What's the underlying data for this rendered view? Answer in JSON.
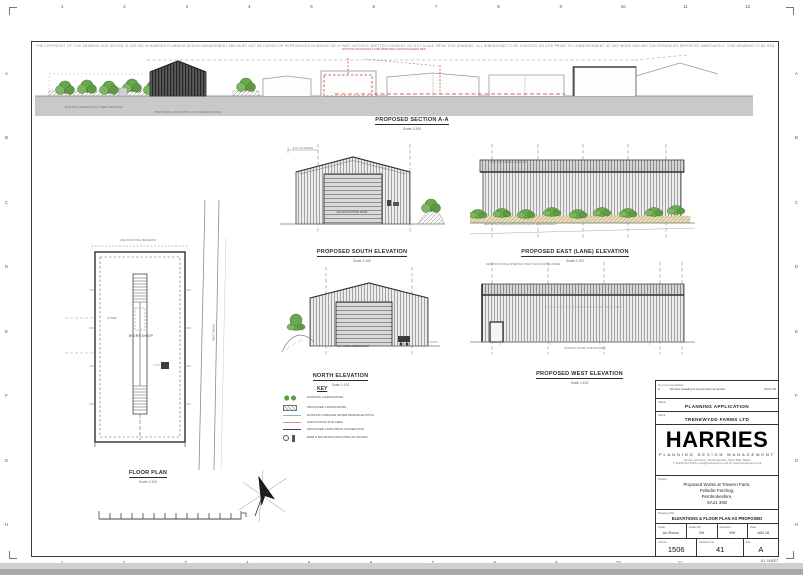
{
  "colors": {
    "demolition_red": "#c0392b",
    "landscape_green": "#6aa84f",
    "ground_grey": "#c9c9c9",
    "drain_lightblue": "#8ab4d8",
    "site_pink": "#d98a8a",
    "drain_darkblue": "#3b4a6b"
  },
  "sheet": {
    "disclaimer": "THE COPYRIGHT OF THIS DRAWING AND DESIGN IS VESTED IN HARRIES PLANNING DESIGN MANAGEMENT AND MUST NOT BE COPIED OR REPRODUCED IN WHOLE OR IN PART WITHOUT WRITTEN CONSENT. DO NOT SCALE FROM THIS DRAWING. ALL DIMENSIONS TO BE CHECKED ON SITE PRIOR TO COMMENCEMENT OF ANY WORK AND ANY DISCREPANCIES REPORTED IMMEDIATELY. THIS DRAWING TO BE READ IN CONJUNCTION WITH ALL RELEVANT CONSULTANTS DRAWINGS AND SPECIFICATIONS.",
    "size_label": "A1 SHEET",
    "frame": {
      "top_numbers": [
        "1",
        "2",
        "3",
        "4",
        "5",
        "6",
        "7",
        "8",
        "9",
        "10",
        "11",
        "12"
      ],
      "bottom_numbers": [
        "1",
        "2",
        "3",
        "4",
        "5",
        "6",
        "7",
        "8",
        "9",
        "10",
        "11"
      ],
      "left_letters": [
        "A",
        "B",
        "C",
        "D",
        "E",
        "F",
        "G",
        "H"
      ],
      "right_letters": [
        "A",
        "B",
        "C",
        "D",
        "E",
        "F",
        "G",
        "H"
      ]
    }
  },
  "drawings": {
    "section": {
      "title": "PROPOSED SECTION A-A",
      "scale": "Scale 1:200",
      "red_note": "EXISTING BUILDINGS TO BE REMOVED SHOWN DASHED RED",
      "hedge_note": "EXISTING HEDGEROW & TREES RETAINED",
      "landscape_note": "PROPOSED LANDSCAPING TO SCREEN BUILDING"
    },
    "south": {
      "title": "PROPOSED SOUTH ELEVATION",
      "scale": "Scale 1:100",
      "ridge_note": "6.1m TO RIDGE",
      "door_note": "ROLLER SHUTTER DOOR"
    },
    "east": {
      "title": "PROPOSED EAST (LANE) ELEVATION",
      "scale": "Scale 1:100",
      "note": "NEW NATIVE HEDGEROW PLANTING ALONG LANE BOUNDARY",
      "cladding_note": "GREY BOX PROFILE CLADDING"
    },
    "north": {
      "title": "NORTH ELEVATION",
      "scale": "Scale 1:100",
      "door_note": "6.0m WIDE ACCESS DOOR"
    },
    "west": {
      "title": "PROPOSED WEST ELEVATION",
      "scale": "Scale 1:100",
      "top_note": "NEW BOX PROFILE SHEETING FIXED OVER EXISTING FRAME",
      "wall_note": "EXISTING CONCRETE PANELS RETAINED",
      "base_note": "EXISTING FLOOR SLAB RETAINED"
    },
    "plan": {
      "title": "FLOOR PLAN",
      "scale": "Scale 1:100",
      "room_label": "WORKSHOP",
      "store_label": "STORE",
      "lane_label": "FARM LANE",
      "top_note": "LINE OF EXISTING HEDGEROW"
    }
  },
  "key": {
    "title": "KEY",
    "items": [
      {
        "symbol": "trees",
        "label": "EXISTING LANDSCAPING"
      },
      {
        "symbol": "hatch",
        "label": "PROPOSED LANDSCAPING"
      },
      {
        "symbol": "line-lightblue",
        "label": "EXISTING SURFACE WATER DRAINAGE DITCH"
      },
      {
        "symbol": "line-pink",
        "label": "APPLICATION SITE AREA"
      },
      {
        "symbol": "line-darkblue",
        "label": "PROPOSED LAND DRAIN CONNECTION"
      },
      {
        "symbol": "circle",
        "label": "BIRD & BAT BOXES MOUNTED AS SHOWN"
      }
    ]
  },
  "title_block": {
    "revisions": {
      "headers": [
        "No.",
        "Comments",
        "Date"
      ],
      "rows": [
        [
          "A",
          "Window detailing & fenestration amended",
          "09.01.18"
        ]
      ]
    },
    "status": {
      "label": "Status",
      "value": "PLANNING APPLICATION"
    },
    "client": {
      "label": "Client",
      "value": "TRENEWYDD FARMS LTD"
    },
    "logo": {
      "name": "HARRIES",
      "tagline": "PLANNING  DESIGN  MANAGEMENT",
      "address": "Hendre, Aberbanc, Pembrokeshire, SA41 3NE, Wales",
      "contact": "T: 01239 841 259   E: post@harriespdm.co.uk   W: www.harriespdm.co.uk"
    },
    "project": {
      "label": "Project",
      "lines": [
        "Proposed Works at Trewern Farm,",
        "Felindre Farchog,",
        "Pembrokeshire,",
        "SA41 3XE"
      ]
    },
    "drawing_title": {
      "label": "Drawing Title",
      "value": "ELEVATIONS & FLOOR PLAN AS PROPOSED"
    },
    "meta": [
      {
        "label": "Scale",
        "value": "As Shown"
      },
      {
        "label": "Drawn By",
        "value": "DH"
      },
      {
        "label": "Checked",
        "value": "WH"
      },
      {
        "label": "Date",
        "value": "JAN 18"
      }
    ],
    "numbers": [
      {
        "label": "Job No.",
        "value": "1506"
      },
      {
        "label": "Drawing No.",
        "value": "41"
      },
      {
        "label": "Rev.",
        "value": "A"
      }
    ]
  }
}
